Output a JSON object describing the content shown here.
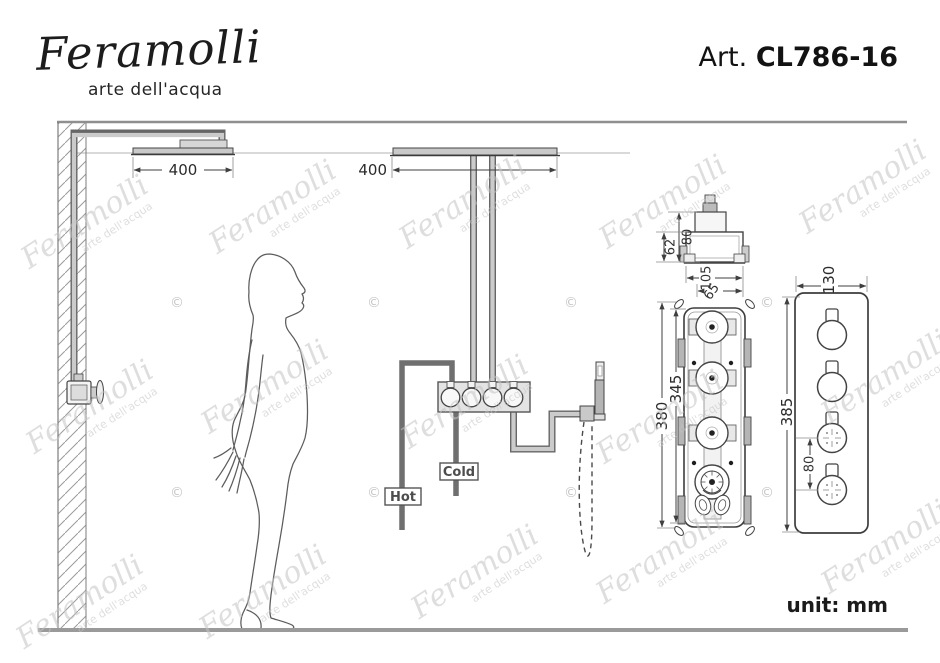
{
  "header": {
    "brand": "Feramolli",
    "tagline": "arte dell'acqua",
    "art_label": "Art.",
    "art_code": "CL786-16"
  },
  "watermark": {
    "brand": "Feramolli",
    "tagline": "arte dell'acqua",
    "copyright": "©"
  },
  "diagram": {
    "labels": {
      "hot": "Hot",
      "cold": "Cold"
    },
    "dimensions": {
      "left_shower_width": "400",
      "ceiling_shower_width": "400",
      "valve_top_total_height": "80",
      "valve_top_body_height": "62",
      "valve_top_width": "105",
      "valve_top_inner_width": "65",
      "valve_body_height": "380",
      "valve_body_inner_height": "345",
      "faceplate_width": "130",
      "faceplate_height": "385",
      "handle_spacing": "80"
    },
    "unit_note": "unit: mm"
  },
  "colors": {
    "ink": "#3f3f3f",
    "pipe_gray": "#9a9a9a",
    "watermark_gray": "#c4c4c4",
    "background": "#ffffff"
  }
}
